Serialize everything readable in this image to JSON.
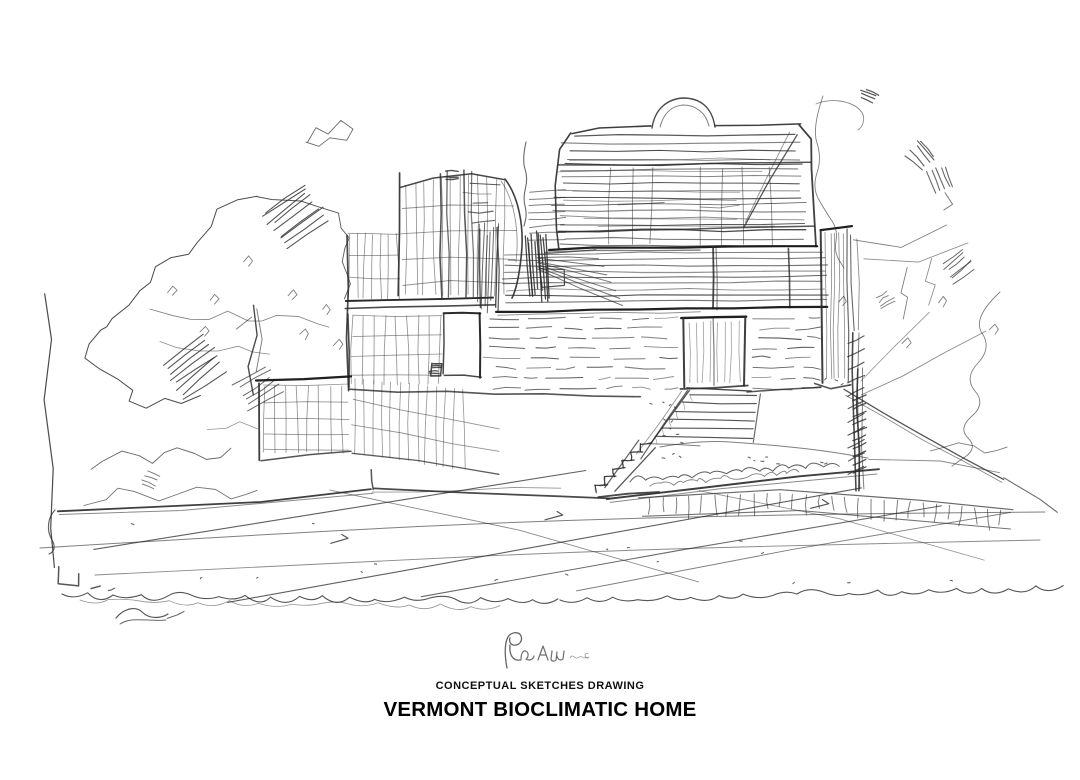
{
  "page": {
    "background": "#ffffff",
    "ink": "#2a2a2a",
    "ink_dark": "#141414",
    "signature_ink": "#4a4a4a"
  },
  "artwork": {
    "type": "hand-drawn architectural concept sketch, black pen on white paper",
    "subject": "Multi-storey bioclimatic home on a terraced site: curved-roof upper volume with horizontal shading, curved glass tower, stone base with entry door, switchback stairs, grass berm, paved forecourt with perspective joint lines, trees left and right",
    "signature": "artist monogram signature scribble"
  },
  "caption": {
    "subtitle": "CONCEPTUAL SKETCHES DRAWING",
    "title": "VERMONT BIOCLIMATIC HOME"
  }
}
